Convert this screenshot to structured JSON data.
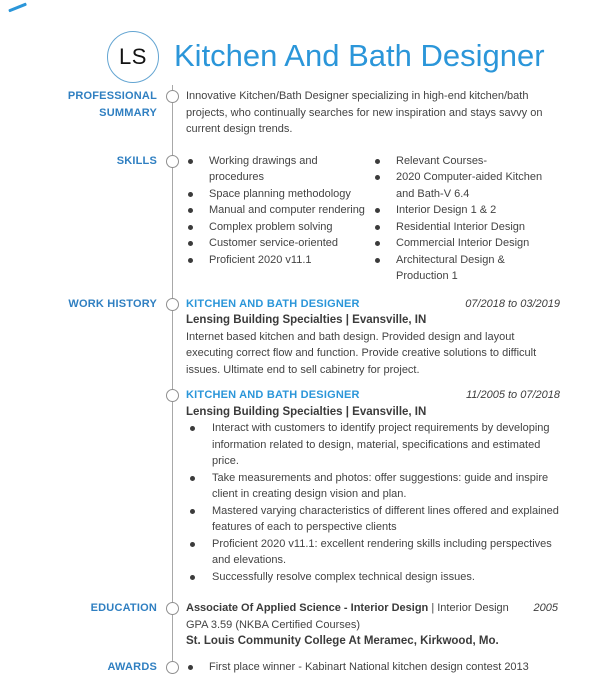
{
  "page": {
    "initials": "LS",
    "title": "Kitchen And Bath Designer"
  },
  "colors": {
    "accent_blue": "#2b96d9",
    "label_blue": "#2f7fc1",
    "timeline_gray": "#a8a8a8"
  },
  "professional_summary": {
    "label": "PROFESSIONAL SUMMARY",
    "text": "Innovative Kitchen/Bath Designer specializing in high-end kitchen/bath projects, who continually searches for new inspiration and stays savvy on current design trends."
  },
  "skills": {
    "label": "SKILLS",
    "column1": [
      "Working drawings and procedures",
      "Space planning methodology",
      "Manual and computer rendering",
      "Complex problem solving",
      "Customer service-oriented",
      "Proficient 2020 v11.1"
    ],
    "column2": [
      "Relevant Courses-",
      "2020 Computer-aided Kitchen and Bath-V 6.4",
      "Interior Design 1 & 2",
      "Residential Interior Design",
      "Commercial Interior Design",
      "Architectural Design & Production 1"
    ]
  },
  "work_history": {
    "label": "WORK HISTORY",
    "jobs": [
      {
        "title": "KITCHEN AND BATH DESIGNER",
        "dates": "07/2018 to 03/2019",
        "company": "Lensing Building Specialties | Evansville, IN",
        "description": "Internet based kitchen and bath design. Provided design and layout executing correct flow and function. Provide creative solutions to difficult issues.  Ultimate end  to sell cabinetry for project."
      },
      {
        "title": "KITCHEN AND BATH DESIGNER",
        "dates": "11/2005 to 07/2018",
        "company": "Lensing Building Specialties | Evansville, IN",
        "bullets": [
          "Interact with customers to identify project requirements by developing information related to design, material, specifications and estimated price.",
          "Take measurements and photos:  offer suggestions: guide and inspire client in creating design vision and plan.",
          "Mastered varying characteristics of different lines offered and explained features of each to perspective clients",
          "Proficient 2020 v11.1: excellent  rendering skills including perspectives and elevations.",
          "Successfully resolve complex technical design issues."
        ]
      }
    ]
  },
  "education": {
    "label": "EDUCATION",
    "degree": "Associate Of Applied Science - Interior Design",
    "detail": "| Interior Design GPA 3.59 (NKBA Certified Courses)",
    "year": "2005",
    "school": "St. Louis Community College At Meramec, Kirkwood, Mo."
  },
  "awards": {
    "label": "AWARDS",
    "items": [
      "First place winner - Kabinart National kitchen design contest 2013"
    ]
  }
}
